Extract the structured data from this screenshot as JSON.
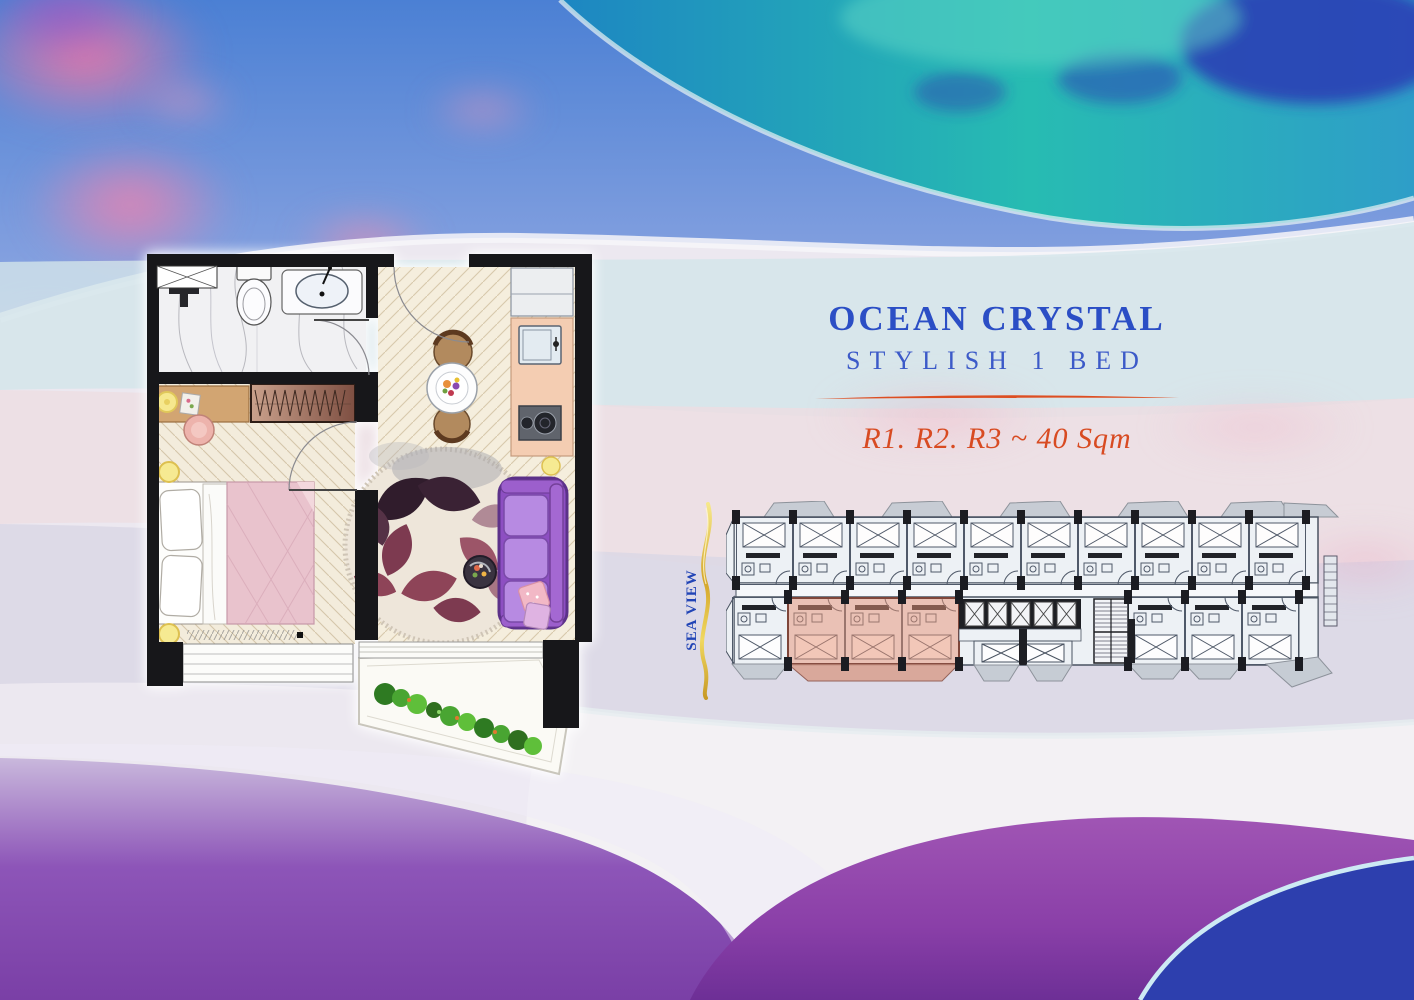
{
  "page": {
    "title": "OCEAN CRYSTAL",
    "subtitle": "STYLISH 1 BED",
    "units_line": "R1. R2. R3 ~ 40 Sqm",
    "sea_view_label": "SEA VIEW"
  },
  "colors": {
    "title_blue": "#2b4ec5",
    "subtitle_blue": "#3c5ac8",
    "accent_orange": "#dd4e22",
    "sea_view_blue": "#2144b6",
    "gold_wave": "#e2b93c",
    "highlight_unit_pink": "#e89070",
    "highlight_unit_outline": "#7c4034",
    "sofa_purple": "#8d4fc2",
    "rug_burgundy": "#8e4458",
    "bed_blanket_pink": "#e9c3cd",
    "teal_wave": "#27bcb2",
    "sand_purple": "#8d4fb3",
    "ocean_deep_blue": "#2d3fae"
  }
}
